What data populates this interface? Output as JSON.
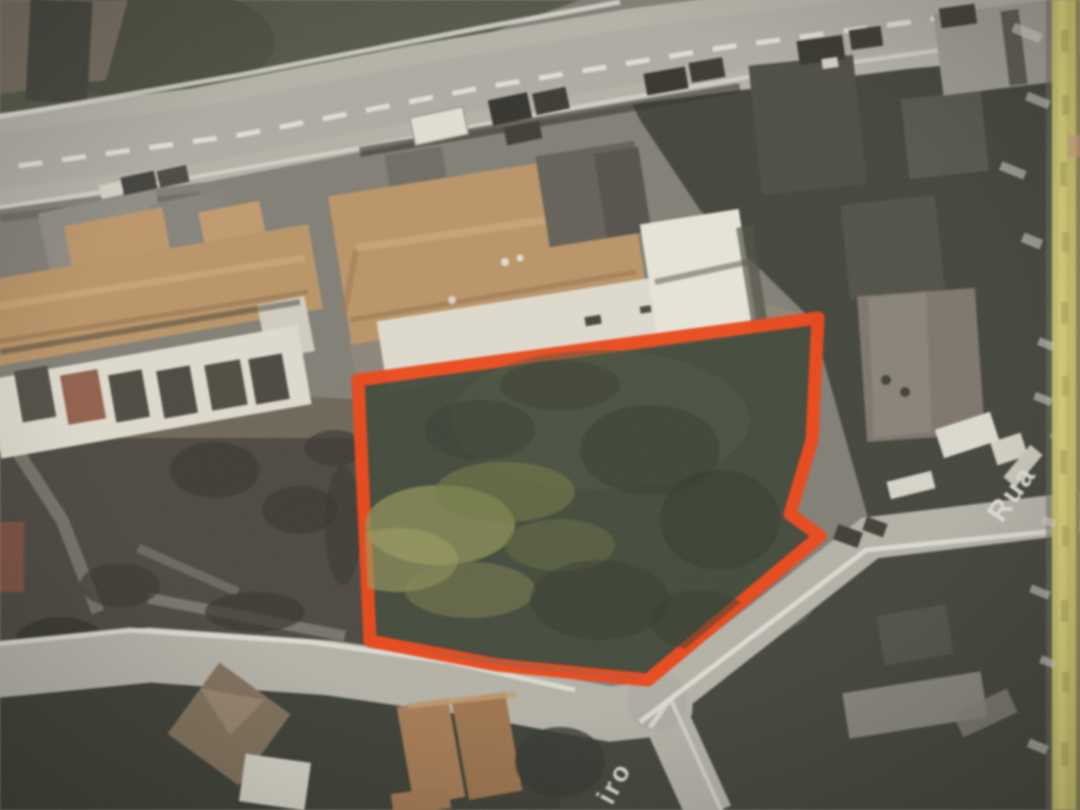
{
  "photo": {
    "description": "Photographed aerial satellite map with a vacant land parcel outlined in red, bordered by roads and tile-roofed buildings"
  },
  "streets": {
    "right_label": "Rua",
    "bottom_label": "iro"
  },
  "parcel": {
    "points_str": "358,380 818,318 812,440 790,514 820,536 648,680 497,665 370,641",
    "outline_color": "#f2400f",
    "fill_color": "#3a4232"
  },
  "colors": {
    "road": "#b6b3aa",
    "road_marking": "#eceae2",
    "vegetation_dark": "#3b3e35",
    "scrub_dark": "#45413a",
    "dirt": "#6a6153",
    "roof_tan": "#bd9364",
    "roof_orange": "#a6784f",
    "building_white": "#e4e0d3",
    "page_edge_yellow": "#cbc369",
    "street_label": "#e9e7de",
    "parcel_highlight": "#8e9054"
  }
}
